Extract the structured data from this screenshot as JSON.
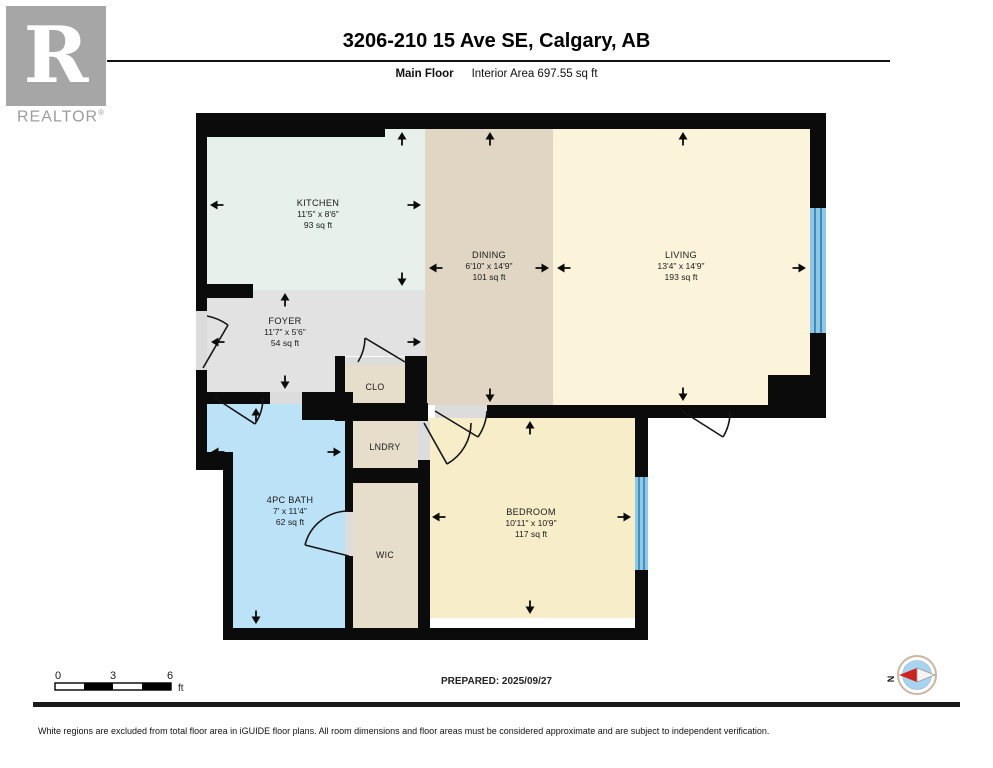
{
  "header": {
    "logo": {
      "letter": "R",
      "brand": "REALTOR",
      "registered": "®",
      "color": "#a6a6a6"
    },
    "title": "3206-210 15 Ave SE, Calgary, AB",
    "floor_label": "Main Floor",
    "area_label": "Interior Area 697.55 sq ft"
  },
  "floorplan": {
    "rooms": [
      {
        "id": "kitchen",
        "name": "KITCHEN",
        "dims": "11'5\" x 8'6\"",
        "area": "93 sq ft"
      },
      {
        "id": "dining",
        "name": "DINING",
        "dims": "6'10\" x 14'9\"",
        "area": "101 sq ft"
      },
      {
        "id": "living",
        "name": "LIVING",
        "dims": "13'4\" x 14'9\"",
        "area": "193 sq ft"
      },
      {
        "id": "foyer",
        "name": "FOYER",
        "dims": "11'7\" x 5'6\"",
        "area": "54 sq ft"
      },
      {
        "id": "bath",
        "name": "4PC BATH",
        "dims": "7' x 11'4\"",
        "area": "62 sq ft"
      },
      {
        "id": "bedroom",
        "name": "BEDROOM",
        "dims": "10'11\" x 10'9\"",
        "area": "117 sq ft"
      },
      {
        "id": "closet",
        "name": "CLO"
      },
      {
        "id": "laundry",
        "name": "LNDRY"
      },
      {
        "id": "wic",
        "name": "WIC"
      }
    ],
    "colors": {
      "wall": "#0b0b0b",
      "kitchen": "#e7f0ea",
      "dining": "#e0d6c3",
      "living": "#fbf4da",
      "foyer": "#e2e2e2",
      "bath": "#bce2f7",
      "bedroom": "#f8edc9",
      "storage": "#e6ddca",
      "sill": "#dcdcdc",
      "window_fill": "#8ec7e8",
      "window_line": "#2f7cab",
      "compass_ring": "#c9b7a3",
      "compass_face": "#a9d4ef",
      "compass_north": "#cc2222"
    }
  },
  "footer": {
    "scale": {
      "ticks": [
        "0",
        "3",
        "6"
      ],
      "unit": "ft"
    },
    "prepared": "PREPARED: 2025/09/27",
    "compass_label": "N",
    "disclaimer": "White regions are excluded from total floor area in iGUIDE floor plans. All room dimensions and floor areas must be considered approximate and are subject to independent verification."
  }
}
